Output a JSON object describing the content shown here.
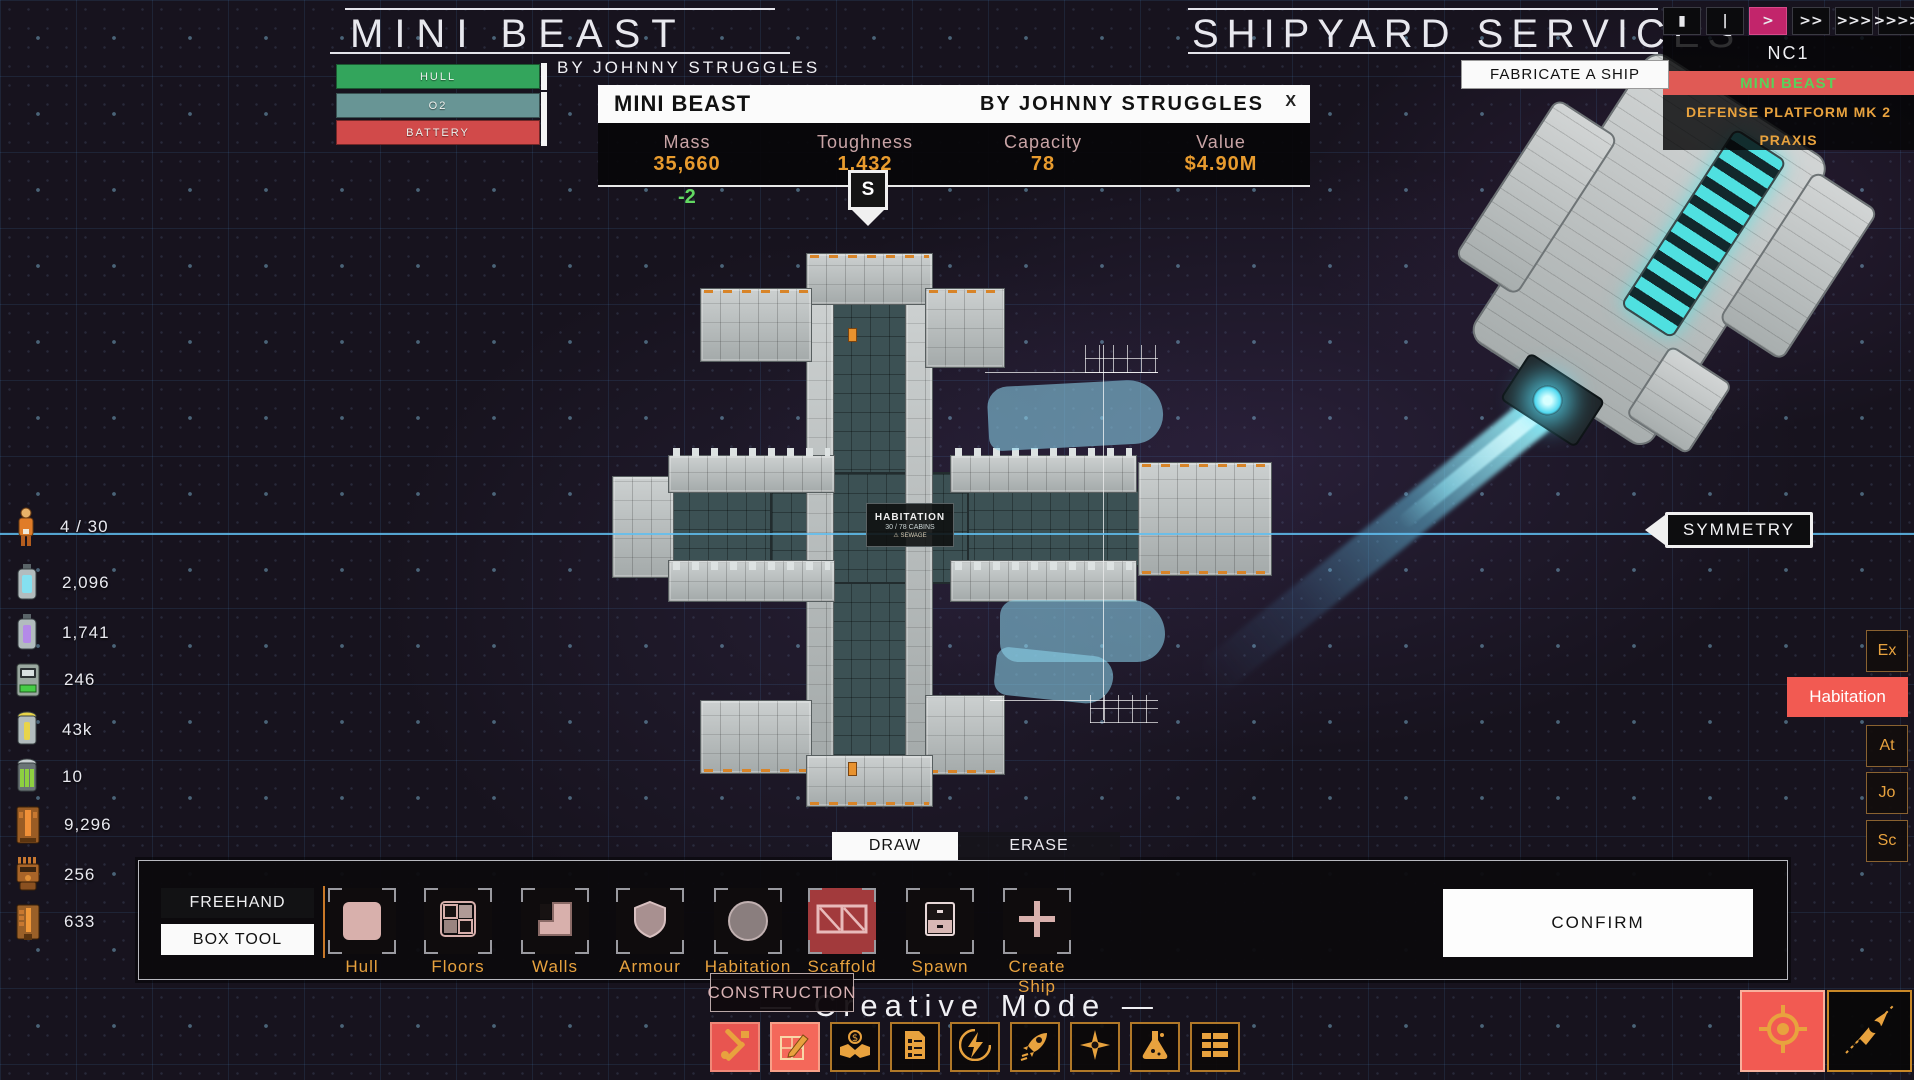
{
  "ship_header": {
    "title": "MINI BEAST",
    "byline": "BY JOHNNY STRUGGLES",
    "bars": [
      {
        "label": "HULL",
        "color": "#33a55c"
      },
      {
        "label": "O2",
        "color": "#689595"
      },
      {
        "label": "BATTERY",
        "color": "#d14a4a"
      }
    ]
  },
  "stats_panel": {
    "title": "MINI BEAST",
    "byline": "BY JOHNNY STRUGGLES",
    "close_label": "X",
    "stats": [
      {
        "label": "Mass",
        "value": "35,660"
      },
      {
        "label": "Toughness",
        "value": "1,432"
      },
      {
        "label": "Capacity",
        "value": "78"
      },
      {
        "label": "Value",
        "value": "$4.90M"
      }
    ],
    "marker_label": "S",
    "delta_value": "-2"
  },
  "shipyard": {
    "title": "SHIPYARD SERVICES",
    "fabricate_label": "FABRICATE A SHIP"
  },
  "time_controls": {
    "buttons": [
      "▮",
      "|",
      ">",
      ">>",
      ">>>",
      ">>>>"
    ],
    "active_index_note": "third button highlighted",
    "active_color": "#c2256b"
  },
  "fleet_panel": {
    "name": "NC1",
    "entries": [
      {
        "label": "MINI BEAST"
      },
      {
        "label": "DEFENSE PLATFORM MK 2"
      },
      {
        "label": "PRAXIS"
      }
    ]
  },
  "resources": [
    {
      "icon": "crew-icon",
      "value": "4 / 30"
    },
    {
      "icon": "coolant-cell-icon",
      "value": "2,096"
    },
    {
      "icon": "fuel-cell-icon",
      "value": "1,741"
    },
    {
      "icon": "battery-pack-icon",
      "value": "246"
    },
    {
      "icon": "gold-cell-icon",
      "value": "43k"
    },
    {
      "icon": "energy-cell-icon",
      "value": "10"
    },
    {
      "icon": "reactor-part-icon",
      "value": "9,296"
    },
    {
      "icon": "machine-part-icon",
      "value": "256"
    },
    {
      "icon": "engine-part-icon",
      "value": "633"
    }
  ],
  "symmetry": {
    "label": "SYMMETRY"
  },
  "side_tabs": [
    {
      "label": "Ex"
    },
    {
      "label": "Habitation"
    },
    {
      "label": "At"
    },
    {
      "label": "Jo"
    },
    {
      "label": "Sc"
    }
  ],
  "ship_overlay": {
    "title": "HABITATION",
    "cabins": "30 / 78 CABINS",
    "warning": "⚠ SEWAGE"
  },
  "draw_tabs": {
    "draw": "DRAW",
    "erase": "ERASE"
  },
  "build_toolbar": {
    "freehand": "FREEHAND",
    "box_tool": "BOX TOOL",
    "tools": [
      {
        "label": "Hull"
      },
      {
        "label": "Floors"
      },
      {
        "label": "Walls"
      },
      {
        "label": "Armour"
      },
      {
        "label": "Habitation"
      },
      {
        "label": "Scaffold"
      },
      {
        "label": "Spawn"
      },
      {
        "label": "Create Ship"
      }
    ],
    "selected_tool": "Scaffold",
    "confirm": "CONFIRM"
  },
  "footer": {
    "tooltip": "CONSTRUCTION",
    "mode_text": "—  Creative Mode  —"
  },
  "colors": {
    "accent_orange": "#e8a23e",
    "salmon": "#f25a52",
    "symmetry_cyan": "#5fbef0",
    "value_orange": "#e89b2e",
    "fleet_selected_text": "#5ad05a"
  }
}
